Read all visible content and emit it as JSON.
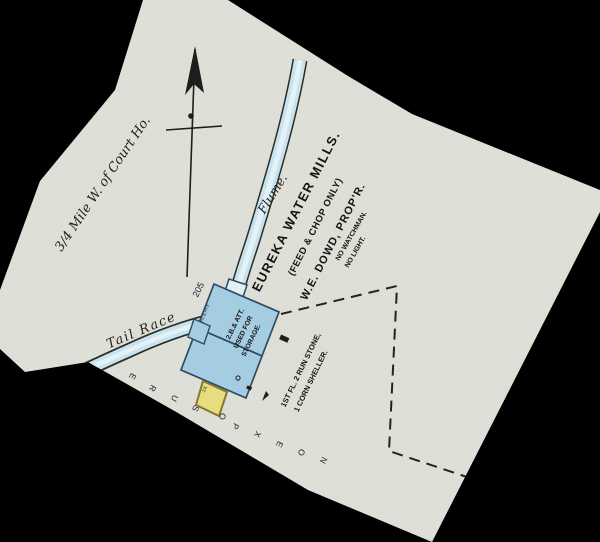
{
  "map": {
    "location_note": "3/4 Mile W. of Court Ho.",
    "title": {
      "line1": "EUREKA WATER MILLS.",
      "line2": "(FEED & CHOP ONLY)",
      "line3": "W.E. DOWD, PROP'R.",
      "note1": "NO WATCHMAN.",
      "note2": "NO LIGHT."
    },
    "labels": {
      "flume": "Flume.",
      "tail_race": "Tail Race",
      "street_number": "205"
    },
    "main_building": {
      "story_line": "2.B.& ATT.",
      "use_line1": "USED FOR",
      "use_line2": "STORAGE.",
      "wheelhouse_note": "2½ B.HTX",
      "floor_note_line1": "1ST FL. 2 RUN STONE,",
      "floor_note_line2": "1 CORN SHELLER."
    },
    "shed": {
      "mark": "1X"
    },
    "exposure": {
      "text": "NO EXPOSURE",
      "letters": [
        "N",
        "O",
        "E",
        "X",
        "P",
        "O",
        "S",
        "U",
        "R",
        "E"
      ]
    },
    "colors": {
      "background": "#000000",
      "paper": "#e9eae2",
      "water_fill": "#c9e3ee",
      "water_light": "#e4f2f7",
      "building_blue": "#a5cde1",
      "shed_yellow": "#e7dd7e",
      "ink": "#1e1e1c"
    }
  }
}
